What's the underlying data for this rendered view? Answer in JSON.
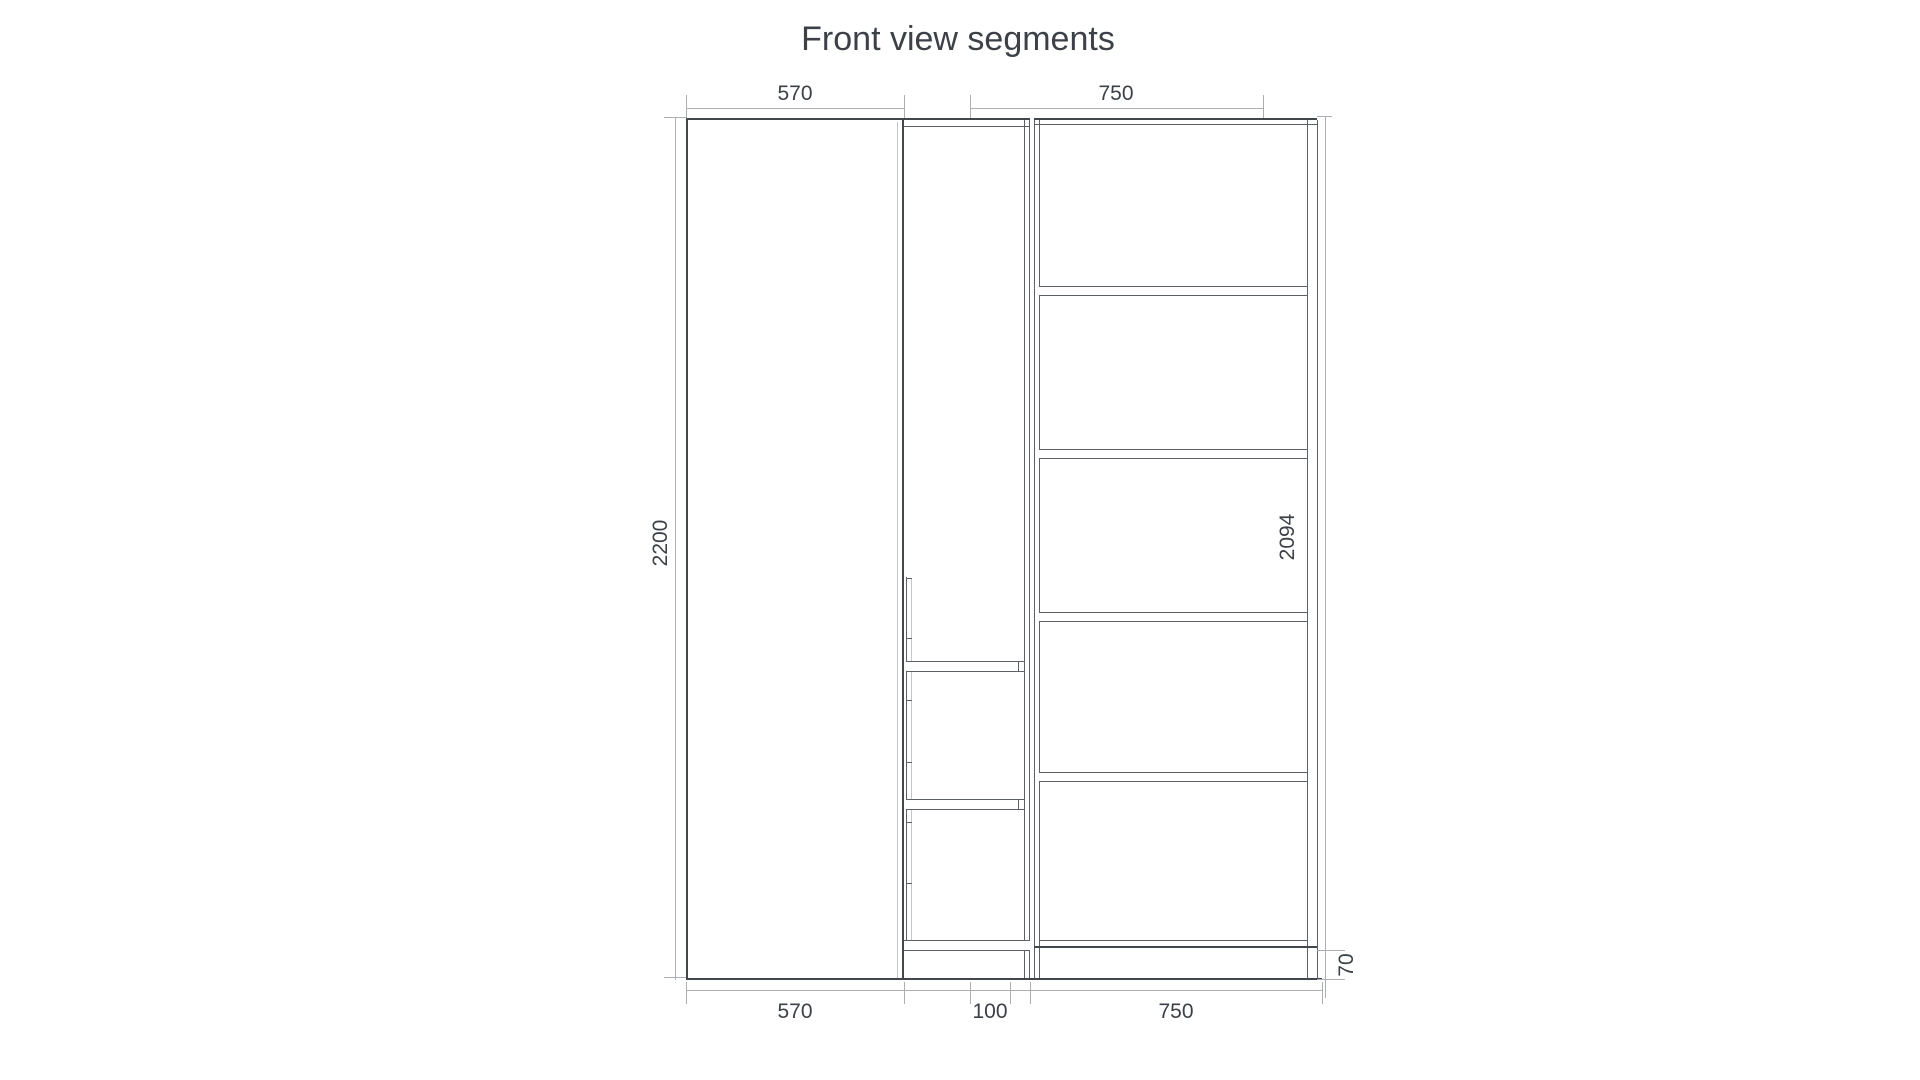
{
  "title": "Front view segments",
  "colors": {
    "outline": "#42474e",
    "line": "#5c6167",
    "dim_line": "#abaeb3",
    "faint": "#c3c6ca",
    "text": "#3c4148",
    "background": "#ffffff"
  },
  "drawing": {
    "type": "furniture front elevation, three segments",
    "dims": {
      "top_left_width": "570",
      "top_right_width": "750",
      "left_height": "2200",
      "right_height": "2094",
      "right_base_height": "70",
      "bottom_left_width": "570",
      "bottom_middle_width": "100",
      "bottom_right_width": "750"
    },
    "segments": [
      {
        "name": "left-door-segment",
        "width_label": "570",
        "height_label": "2200",
        "content": "blank door panel"
      },
      {
        "name": "middle-segment",
        "width_label": "100",
        "content": "two stacked fronts and bottom board, segmented side strip"
      },
      {
        "name": "right-shelf-segment",
        "width_label": "750",
        "height_label": "2094",
        "base_label": "70",
        "shelf_count": 5
      }
    ]
  }
}
